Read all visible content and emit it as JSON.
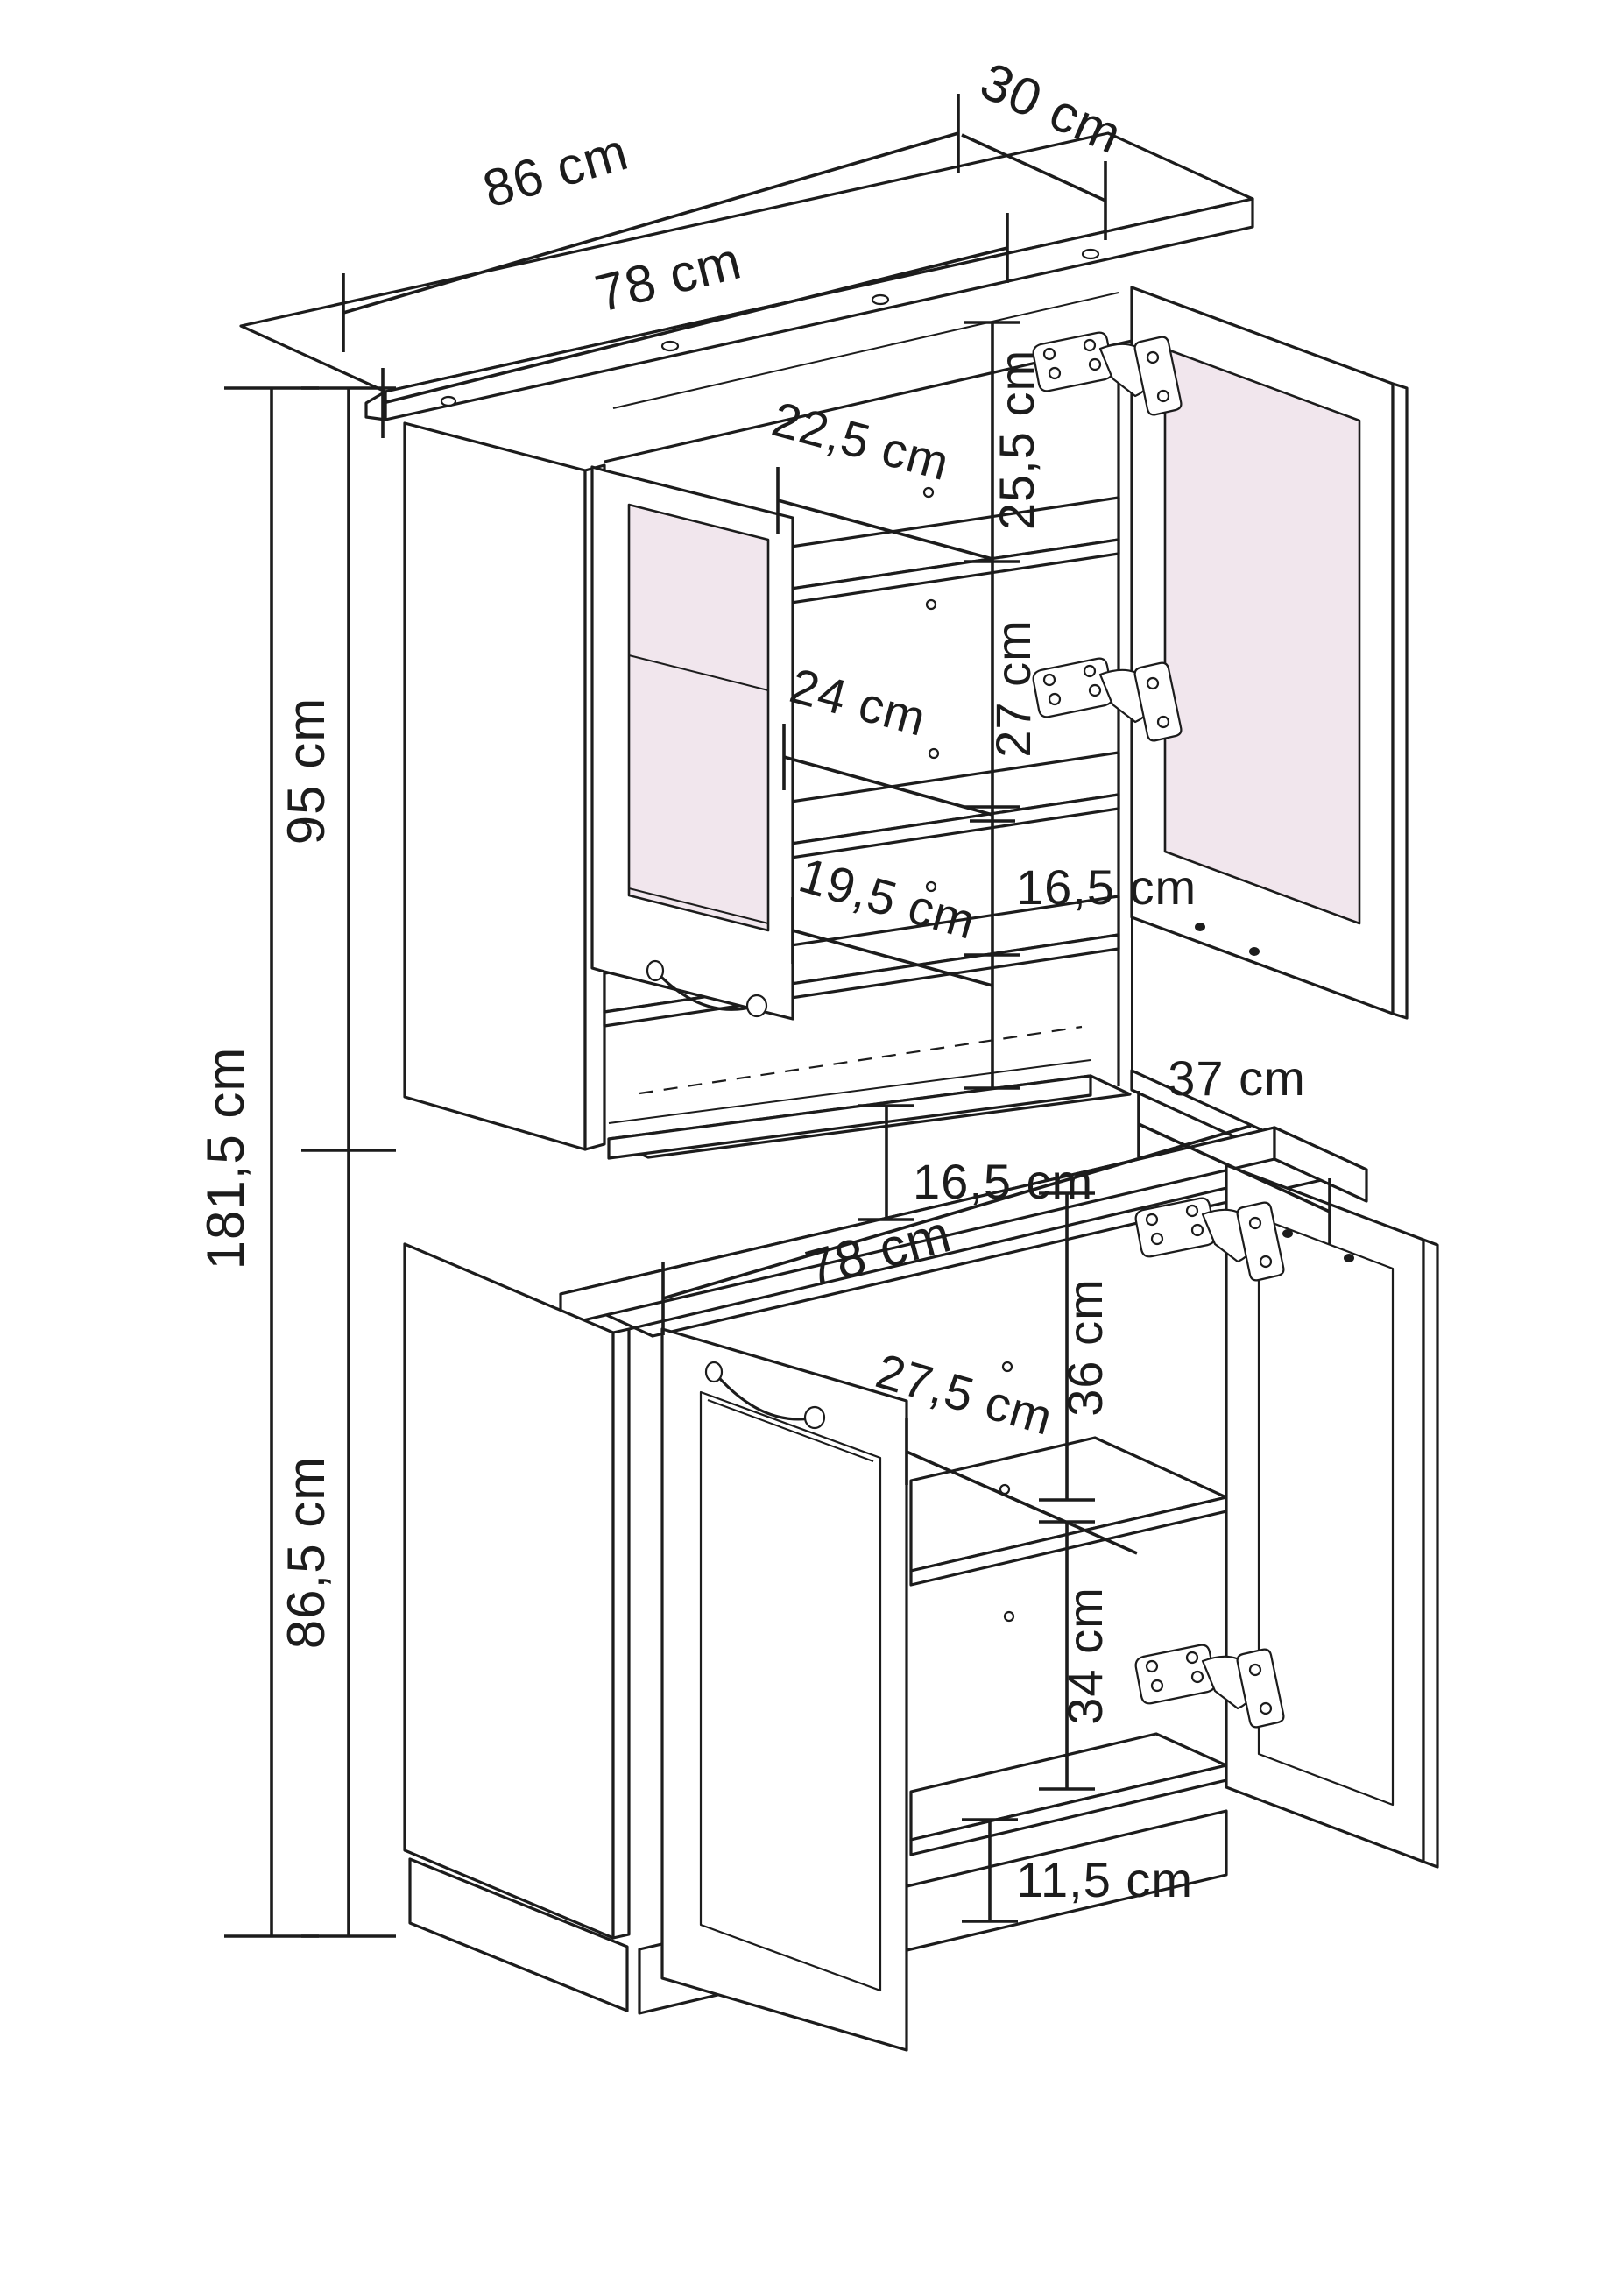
{
  "drawing": {
    "kind": "furniture-dimension-diagram",
    "subject": "buffet hutch cabinet with glass doors, open doors and shelves",
    "unit": "cm",
    "colors": {
      "line": "#1c1c1c",
      "glass": "#f1e6ed",
      "background": "#ffffff"
    },
    "dimensions": {
      "top_board_width": "86 cm",
      "top_board_depth": "30 cm",
      "upper_inner_width": "78 cm",
      "upper_shelf1_space_height": "25,5 cm",
      "upper_shelf1_depth": "22,5 cm",
      "upper_shelf2_space_height": "27 cm",
      "upper_shelf2_depth": "24 cm",
      "upper_shelf3_space_height": "16,5 cm",
      "upper_shelf3_depth": "19,5 cm",
      "upper_cabinet_depth": "37 cm",
      "niche_height": "16,5 cm",
      "counter_width": "78 cm",
      "total_height": "181,5 cm",
      "upper_section_height": "95 cm",
      "lower_section_height": "86,5 cm",
      "lower_shelf_depth": "27,5 cm",
      "lower_space_above_shelf": "36 cm",
      "lower_space_below_shelf": "34 cm",
      "plinth_height": "11,5 cm"
    }
  }
}
